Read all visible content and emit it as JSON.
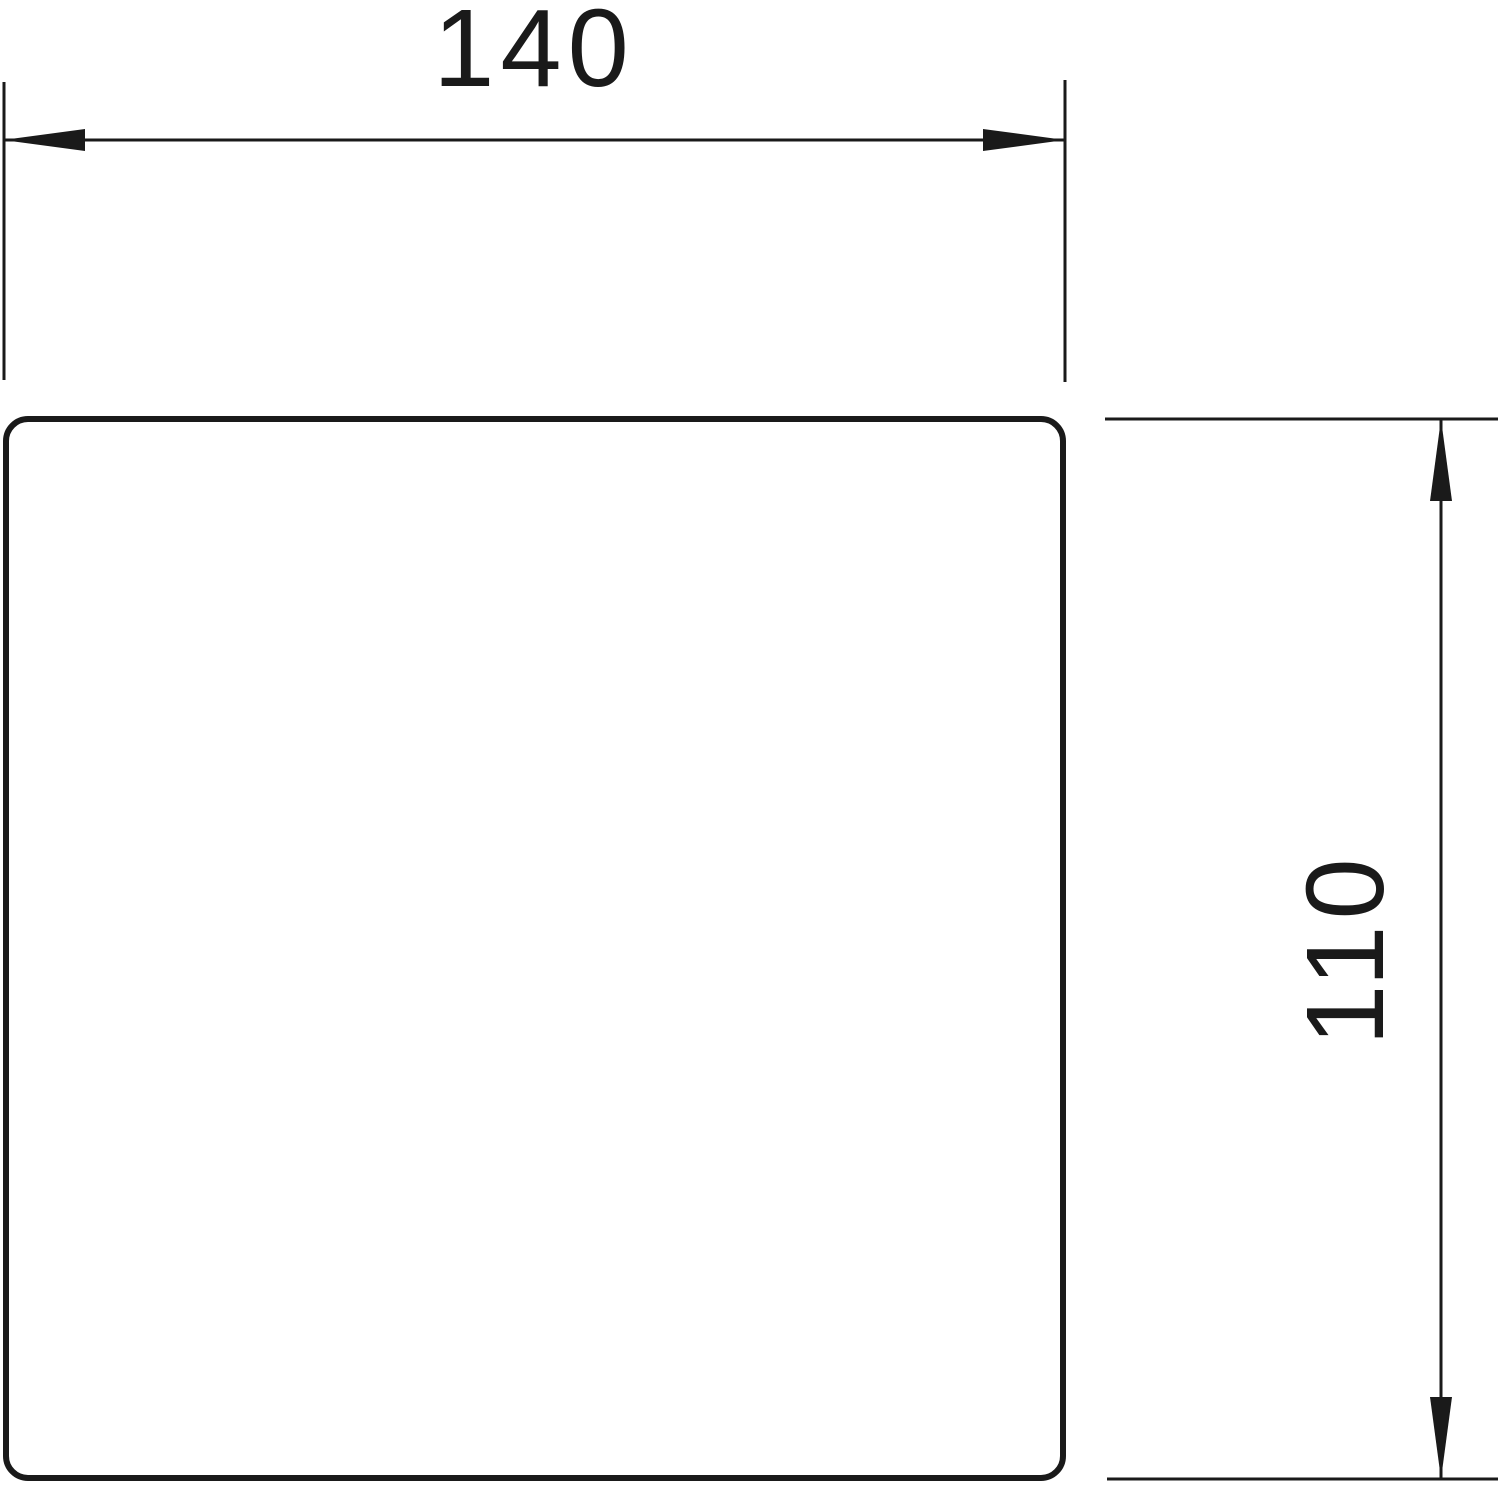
{
  "drawing": {
    "kind": "technical-dimension-drawing",
    "shape": "rounded-square",
    "colors": {
      "background": "#ffffff",
      "line": "#1a1a1a"
    },
    "dimensions": {
      "width": {
        "value": "140",
        "orientation": "horizontal",
        "position": "top"
      },
      "height": {
        "value": "110",
        "orientation": "vertical",
        "position": "right"
      }
    }
  }
}
